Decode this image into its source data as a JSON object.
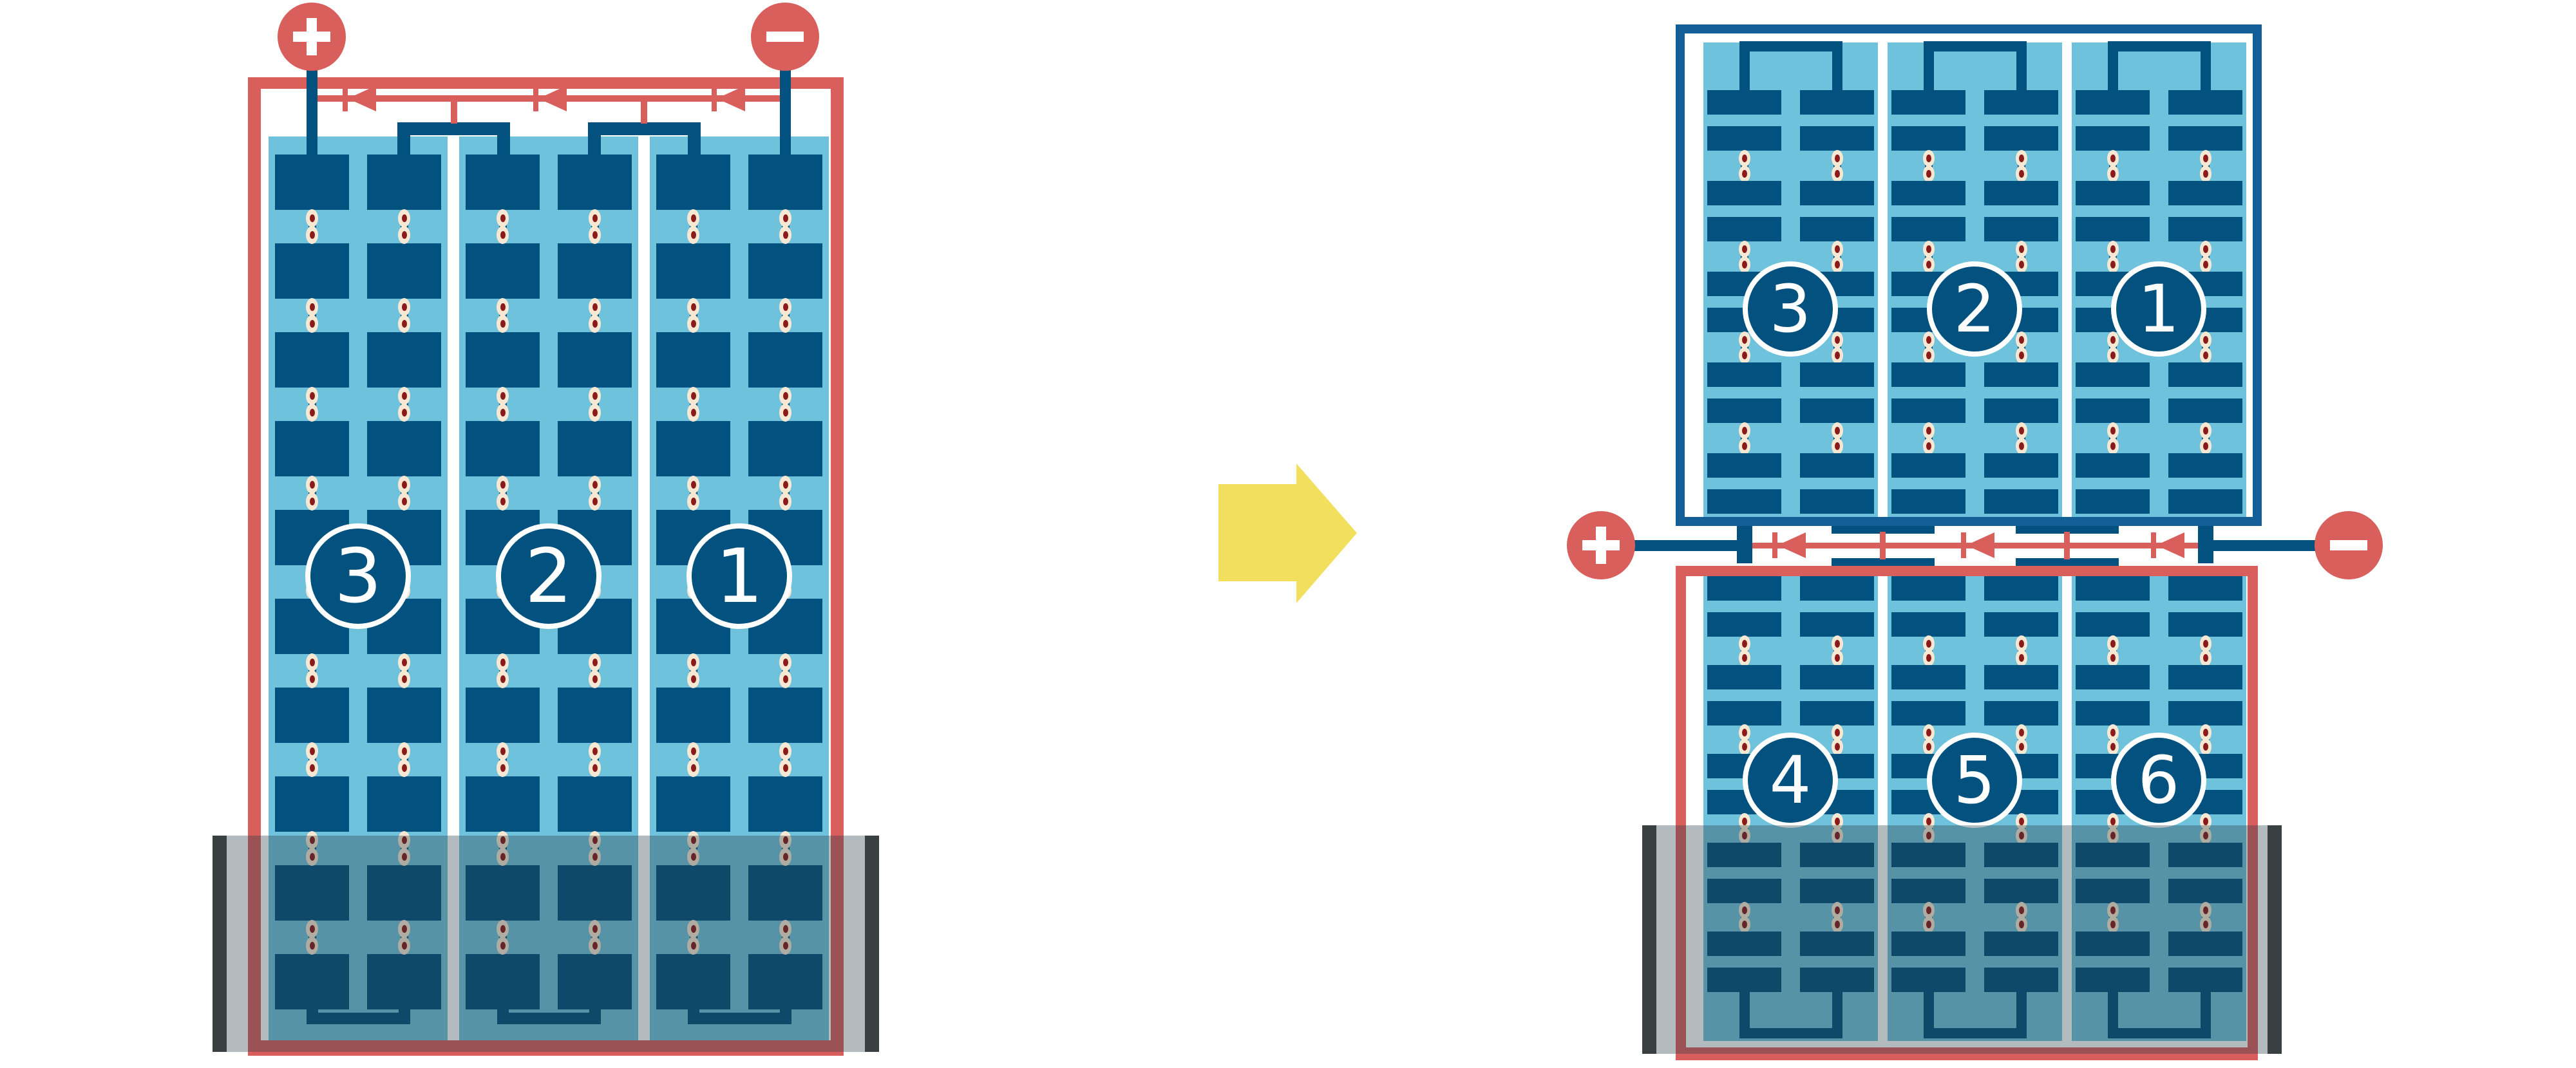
{
  "diagram": {
    "arrow": {
      "direction": "right"
    },
    "terminals": {
      "positive": "+",
      "negative": "-"
    },
    "modules": {
      "left": {
        "cell_type": "full-cell",
        "rows": 10,
        "columns": 6,
        "bypass_diodes": 3,
        "shaded_bottom": true,
        "strings": [
          {
            "label": "3"
          },
          {
            "label": "2"
          },
          {
            "label": "1"
          }
        ]
      },
      "right_top": {
        "cell_type": "half-cell",
        "rows": 10,
        "columns": 6,
        "bypass_diodes": 3,
        "shaded_bottom": false,
        "strings": [
          {
            "label": "3"
          },
          {
            "label": "2"
          },
          {
            "label": "1"
          }
        ]
      },
      "right_bottom": {
        "cell_type": "half-cell",
        "rows": 10,
        "columns": 6,
        "shaded_bottom": true,
        "strings": [
          {
            "label": "4"
          },
          {
            "label": "5"
          },
          {
            "label": "6"
          }
        ]
      }
    },
    "colors": {
      "red": "#D85F5C",
      "navy": "#02517E",
      "light_blue": "#6FC2DB",
      "frame_blue": "#135E96",
      "cream": "#F7E8D3",
      "dot_red": "#8B1A1A",
      "yellow": "#F2DF5E",
      "shade_cap": "#3A3F42",
      "shade_overlay": "rgba(40,60,70,0.35)"
    }
  }
}
